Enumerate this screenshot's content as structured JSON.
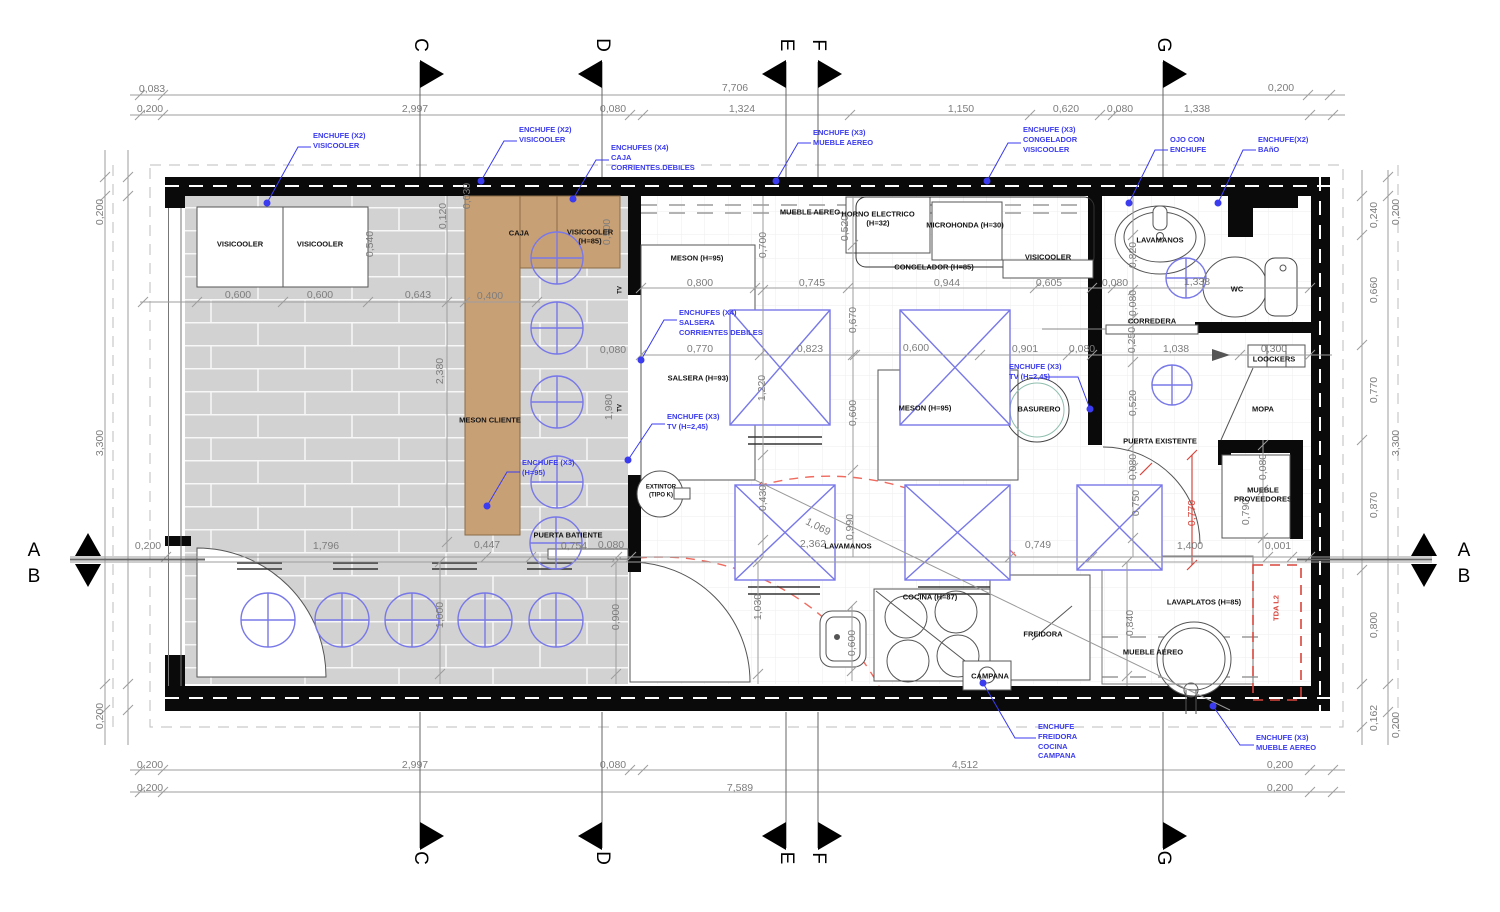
{
  "drawing": {
    "type": "architectural floor plan - retail store / kitchen electrical layout",
    "colors": {
      "wall_black": "#0a0a0a",
      "counter_tan": "#c8a076",
      "tile_gray": "#d2d2d2",
      "annotation_blue": "#3b3bf0",
      "equipment_blue": "#7878e8",
      "dimension_gray": "#7d7d7d",
      "accent_red": "#d9453c",
      "basurero_teal": "#8fbfae"
    }
  },
  "sections": {
    "a": "A",
    "b": "B",
    "c": "C",
    "d": "D",
    "e": "E",
    "f": "F",
    "g": "G"
  },
  "dims": {
    "v0001": "0,001",
    "v0030": "0,030",
    "v0080": "0,080",
    "v0083": "0,083",
    "v0120": "0,120",
    "v0162": "0,162",
    "v0200": "0,200",
    "v0240": "0,240",
    "v0250": "0,250",
    "v0300": "0,300",
    "v0400": "0,400",
    "v0430": "0,430",
    "v0447": "0,447",
    "v0500": "0,500",
    "v0520": "0,520",
    "v0540": "0,540",
    "v0600": "0,600",
    "v0605": "0,605",
    "v0620": "0,620",
    "v0643": "0,643",
    "v0660": "0,660",
    "v0670": "0,670",
    "v0700": "0,700",
    "v0745": "0,745",
    "v0749": "0,749",
    "v0750": "0,750",
    "v0754": "0,754",
    "v0770": "0,770",
    "v0790": "0,790",
    "v0800": "0,800",
    "v0820": "0,820",
    "v0823": "0,823",
    "v0840": "0,840",
    "v0870": "0,870",
    "v0900": "0,900",
    "v0901": "0,901",
    "v0944": "0,944",
    "v0990": "0,990",
    "v1000": "1,000",
    "v1030": "1,030",
    "v1038": "1,038",
    "v1069": "1,069",
    "v1150": "1,150",
    "v1220": "1,220",
    "v1324": "1,324",
    "v1338": "1,338",
    "v1400": "1,400",
    "v1796": "1,796",
    "v1980": "1,980",
    "v2362": "2,362",
    "v2380": "2,380",
    "v2997": "2,997",
    "v3300": "3,300",
    "v4512": "4,512",
    "v7589": "7,589",
    "v7706": "7,706"
  },
  "fixtures": {
    "visicooler": "VISICOOLER",
    "visicooler_h85": "VISICOOLER\n(H=85)",
    "caja": "CAJA",
    "meson_cliente": "MESON CLIENTE",
    "puerta_batiente": "PUERTA BATIENTE",
    "meson_h95": "MESON (H=95)",
    "mueble_aereo": "MUEBLE AEREO",
    "horno": "HORNO ELECTRICO\n(H=32)",
    "microhonda": "MICROHONDA (H=30)",
    "congelador": "CONGELADOR (H=85)",
    "lavamanos": "LAVAMANOS",
    "wc": "WC",
    "corredera": "CORREDERA",
    "loockers": "LOOCKERS",
    "mopa": "MOPA",
    "salsera": "SALSERA (H=93)",
    "basurero": "BASURERO",
    "extintor": "EXTINTOR\n(TIPO K)",
    "puerta_existente": "PUERTA EXISTENTE",
    "mueble_proveedores": "MUEBLE\nPROVEEDORES",
    "cocina": "COCINA (H=87)",
    "freidora": "FREIDORA",
    "campana": "CAMPANA",
    "lavaplatos": "LAVAPLATOS (H=85)",
    "tda": "TDA L2",
    "tv": "TV"
  },
  "enchufes": {
    "visicooler_x2": "ENCHUFE (X2)\nVISICOOLER",
    "caja_x4": "ENCHUFES (X4)\nCAJA\nCORRIENTES.DEBILES",
    "mueble_aereo_x3": "ENCHUFE (X3)\nMUEBLE AEREO",
    "congelador_x3": "ENCHUFE (X3)\nCONGELADOR\nVISICOOLER",
    "ojo": "OJO CON\nENCHUFE",
    "bano": "ENCHUFE(X2)\nBAñO",
    "salsera_x4": "ENCHUFES (X4)\nSALSERA\nCORRIENTES DEBILES",
    "tv_x3": "ENCHUFE (X3)\nTV (H=2,45)",
    "h95_x3": "ENCHUFE (X3)\n(H=95)",
    "freidora_grp": "ENCHUFE\nFREIDORA\nCOCINA\nCAMPANA"
  }
}
